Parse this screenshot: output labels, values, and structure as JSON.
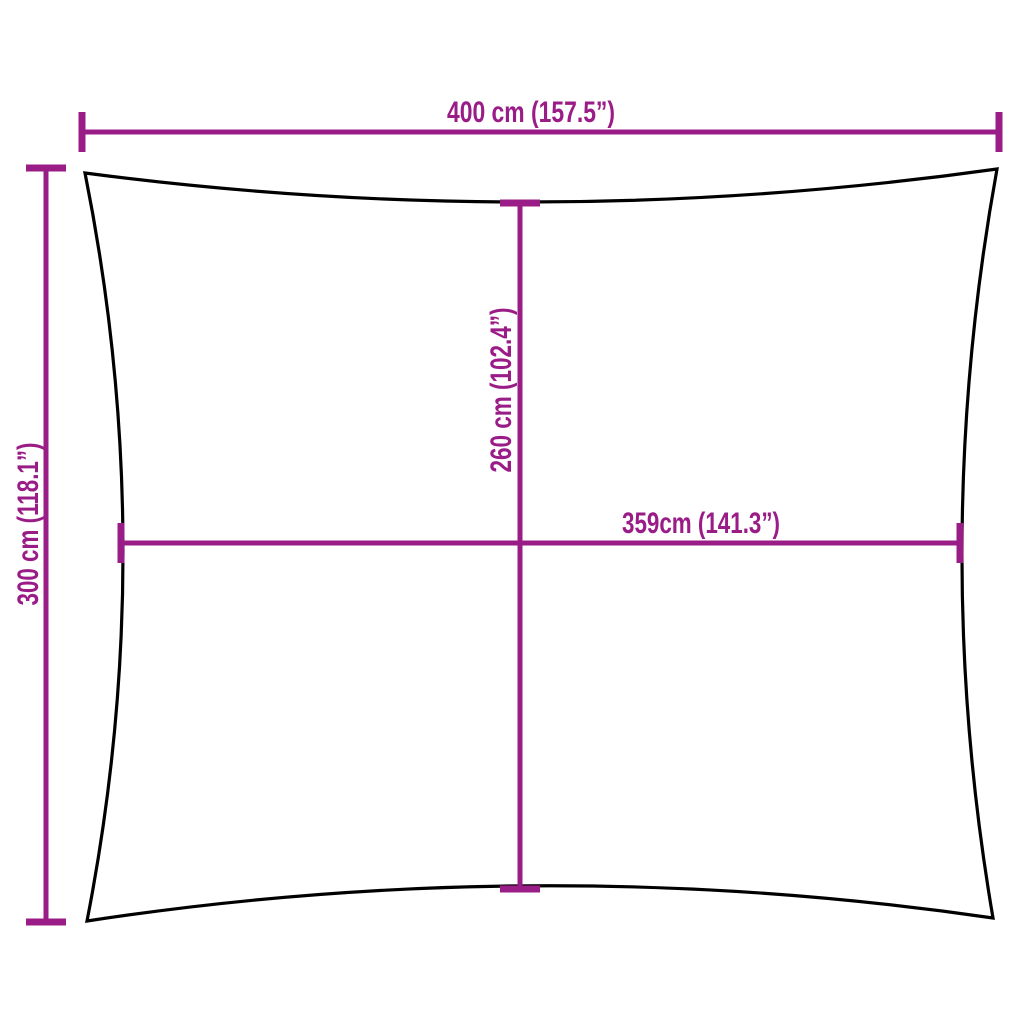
{
  "dimensions": {
    "outer_width": {
      "label": "400 cm (157.5”)"
    },
    "outer_height": {
      "label": "300 cm (118.1”)"
    },
    "inner_height": {
      "label": "260 cm (102.4”)"
    },
    "inner_width": {
      "label": "359cm (141.3”)"
    }
  },
  "colors": {
    "dimension": "#9A1D87",
    "outline": "#000000",
    "background": "#FFFFFF"
  }
}
